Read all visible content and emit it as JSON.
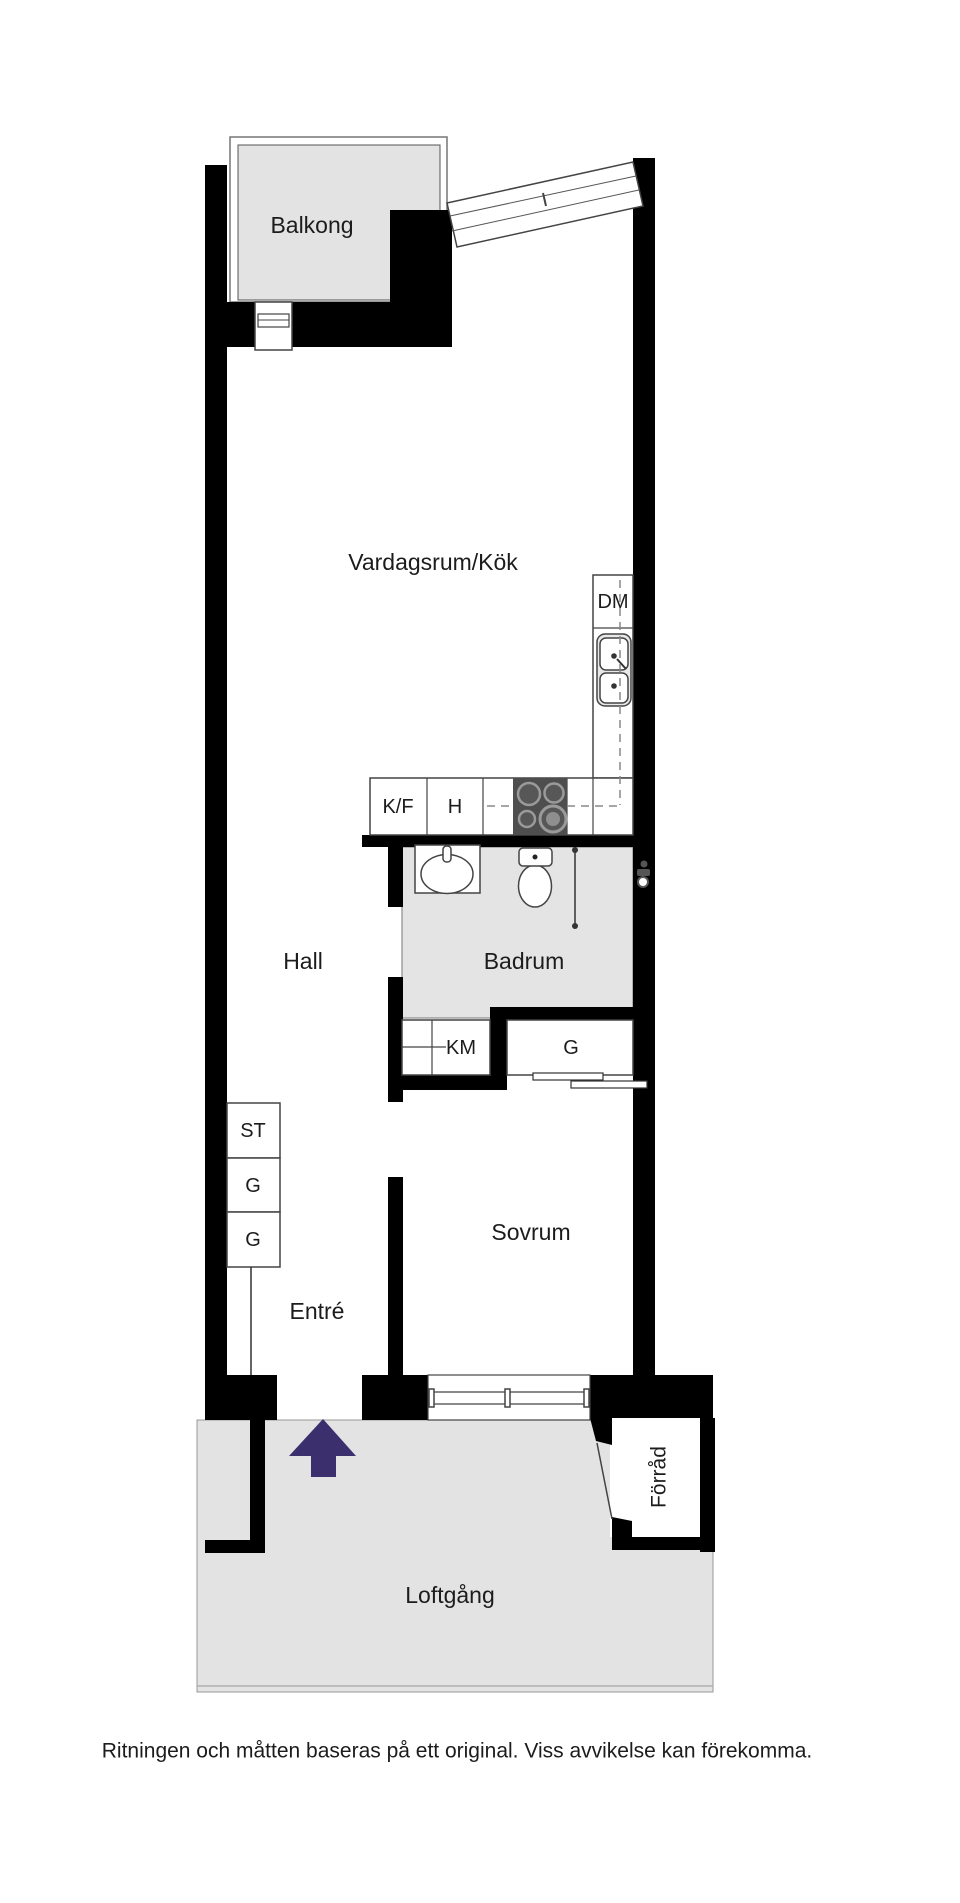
{
  "floorplan": {
    "rooms": {
      "balkong": "Balkong",
      "vardagsrum_kok": "Vardagsrum/Kök",
      "hall": "Hall",
      "badrum": "Badrum",
      "sovrum": "Sovrum",
      "entre": "Entré",
      "forrad": "Förråd",
      "loftgang": "Loftgång"
    },
    "fixtures": {
      "dm": "DM",
      "kf": "K/F",
      "h": "H",
      "km": "KM",
      "g": "G",
      "st": "ST"
    },
    "disclaimer": "Ritningen och måtten baseras på ett original. Viss avvikelse kan förekomma.",
    "colors": {
      "wall": "#000000",
      "outdoor_floor": "#e3e3e3",
      "bathroom_floor": "#e4e4e4",
      "stove": "#4e4e4e",
      "entry_arrow": "#3b2f6e"
    }
  }
}
